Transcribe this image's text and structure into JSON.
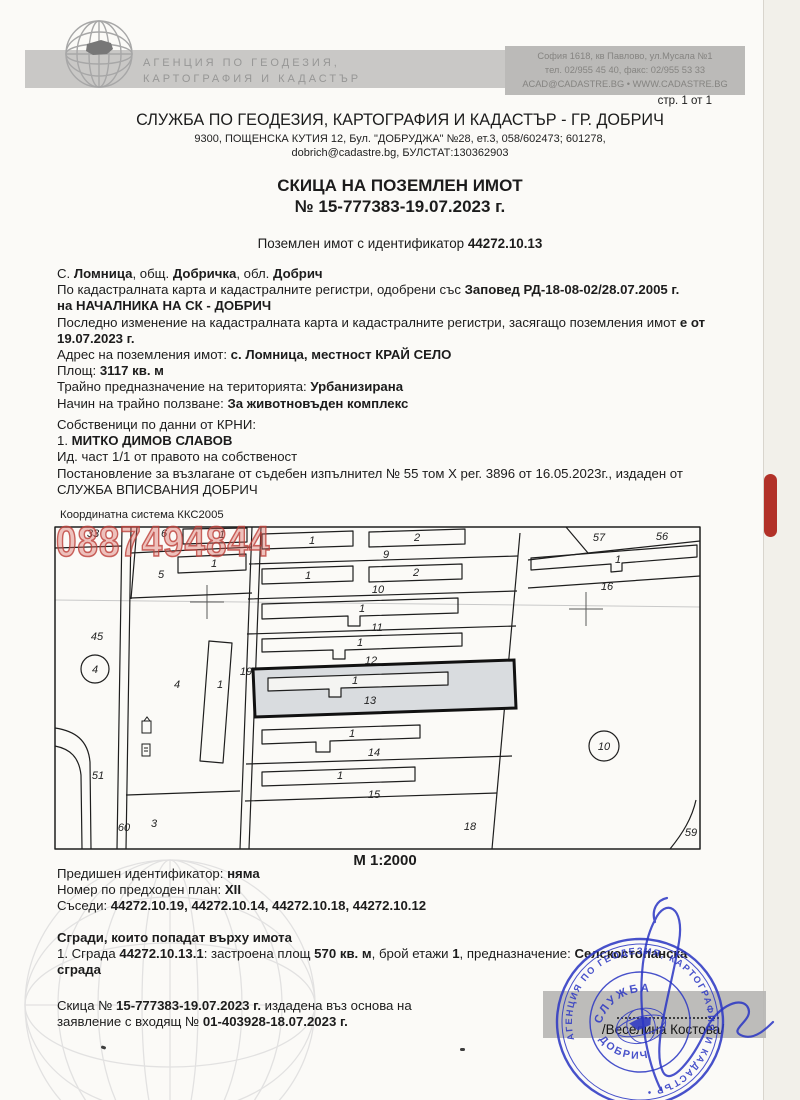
{
  "colors": {
    "accent_red": "#b23128",
    "stamp_blue": "#2f3ac4",
    "watermark_red": "#c0453f",
    "highlight_gray": "#d9dcdf"
  },
  "header": {
    "agency_line1": "АГЕНЦИЯ ПО ГЕОДЕЗИЯ,",
    "agency_line2": "КАРТОГРАФИЯ И КАДАСТЪР",
    "contact_line1": "София 1618, кв Павлово, ул.Мусала №1",
    "contact_line2": "тел. 02/955 45 40, факс: 02/955 53 33",
    "contact_line3": "ACAD@CADASTRE.BG • WWW.CADASTRE.BG",
    "page_num": "стр. 1 от 1",
    "office_title": "СЛУЖБА ПО ГЕОДЕЗИЯ, КАРТОГРАФИЯ И КАДАСТЪР - ГР. ДОБРИЧ",
    "office_addr1": "9300, ПОЩЕНСКА КУТИЯ 12, Бул. \"ДОБРУДЖА\" №28, ет.3, 058/602473; 601278,",
    "office_addr2": "dobrich@cadastre.bg, БУЛСТАТ:130362903"
  },
  "title": {
    "line1": "СКИЦА НА ПОЗЕМЛЕН ИМОТ",
    "line2": "№ 15-777383-19.07.2023 г."
  },
  "subtitle": [
    [
      "Поземлен имот с  идентификатор ",
      0
    ],
    [
      "44272.10.13",
      1
    ]
  ],
  "body": {
    "lines": [
      [
        [
          "С. ",
          0
        ],
        [
          "Ломница",
          1
        ],
        [
          ", общ. ",
          0
        ],
        [
          "Добричка",
          1
        ],
        [
          ", обл. ",
          0
        ],
        [
          "Добрич",
          1
        ]
      ],
      [
        [
          "По кадастралната карта и кадастралните регистри, одобрени със ",
          0
        ],
        [
          "Заповед РД-18-08-02/28.07.2005 г.",
          1
        ]
      ],
      [
        [
          "на НАЧАЛНИКА НА СК - ДОБРИЧ",
          1
        ]
      ],
      [
        [
          "Последно изменение на кадастралната карта и кадастралните регистри, засягащо поземления имот ",
          0
        ],
        [
          "е от",
          1
        ]
      ],
      [
        [
          "19.07.2023 г.",
          1
        ]
      ],
      [
        [
          "Адрес на поземления имот: ",
          0
        ],
        [
          "с. Ломница, местност КРАЙ СЕЛО",
          1
        ]
      ],
      [
        [
          "Площ: ",
          0
        ],
        [
          "3117 кв. м",
          1
        ]
      ],
      [
        [
          "Трайно предназначение на територията: ",
          0
        ],
        [
          "Урбанизирана",
          1
        ]
      ],
      [
        [
          "Начин на трайно ползване: ",
          0
        ],
        [
          "За животновъден комплекс",
          1
        ]
      ]
    ]
  },
  "owners": {
    "lines": [
      [
        [
          "Собственици по данни от КРНИ:",
          0
        ]
      ],
      [
        [
          "1. ",
          0
        ],
        [
          "МИТКО ДИМОВ СЛАВОВ",
          1
        ]
      ],
      [
        [
          "Ид. част 1/1 от правото на собственост",
          0
        ]
      ],
      [
        [
          "Постановление за възлагане от съдебен изпълнител № 55 том X рег. 3896 от 16.05.2023г., издаден от",
          0
        ]
      ],
      [
        [
          "СЛУЖБА ВПИСВАНИЯ ДОБРИЧ",
          0
        ]
      ]
    ]
  },
  "map": {
    "coord_system": "Координатна система ККС2005",
    "scale": "М 1:2000",
    "watermark": "0887494844",
    "highlighted_parcel": "13",
    "labels": [
      {
        "x": 93,
        "y": 537,
        "t": "33"
      },
      {
        "x": 164,
        "y": 537,
        "t": "6"
      },
      {
        "x": 222,
        "y": 538,
        "t": "1"
      },
      {
        "x": 161,
        "y": 578,
        "t": "5"
      },
      {
        "x": 214,
        "y": 567,
        "t": "1"
      },
      {
        "x": 97,
        "y": 640,
        "t": "45"
      },
      {
        "x": 177,
        "y": 688,
        "t": "4"
      },
      {
        "x": 220,
        "y": 688,
        "t": "1"
      },
      {
        "x": 246,
        "y": 675,
        "t": "19"
      },
      {
        "x": 98,
        "y": 779,
        "t": "51"
      },
      {
        "x": 124,
        "y": 831,
        "t": "60"
      },
      {
        "x": 154,
        "y": 827,
        "t": "3"
      },
      {
        "x": 312,
        "y": 544,
        "t": "1"
      },
      {
        "x": 417,
        "y": 541,
        "t": "2"
      },
      {
        "x": 386,
        "y": 558,
        "t": "9"
      },
      {
        "x": 308,
        "y": 579,
        "t": "1"
      },
      {
        "x": 416,
        "y": 576,
        "t": "2"
      },
      {
        "x": 378,
        "y": 593,
        "t": "10"
      },
      {
        "x": 362,
        "y": 612,
        "t": "1"
      },
      {
        "x": 377,
        "y": 631,
        "t": "11"
      },
      {
        "x": 360,
        "y": 646,
        "t": "1"
      },
      {
        "x": 371,
        "y": 664,
        "t": "12"
      },
      {
        "x": 355,
        "y": 684,
        "t": "1"
      },
      {
        "x": 370,
        "y": 704,
        "t": "13"
      },
      {
        "x": 352,
        "y": 737,
        "t": "1"
      },
      {
        "x": 374,
        "y": 756,
        "t": "14"
      },
      {
        "x": 340,
        "y": 779,
        "t": "1"
      },
      {
        "x": 374,
        "y": 798,
        "t": "15"
      },
      {
        "x": 470,
        "y": 830,
        "t": "18"
      },
      {
        "x": 599,
        "y": 541,
        "t": "57"
      },
      {
        "x": 662,
        "y": 540,
        "t": "56"
      },
      {
        "x": 618,
        "y": 563,
        "t": "1"
      },
      {
        "x": 607,
        "y": 590,
        "t": "16"
      },
      {
        "x": 691,
        "y": 836,
        "t": "59"
      }
    ],
    "circles": [
      {
        "x": 95,
        "y": 669,
        "r": 14,
        "t": "4"
      },
      {
        "x": 604,
        "y": 746,
        "r": 15,
        "t": "10"
      }
    ]
  },
  "footer": {
    "lines": [
      [
        [
          "Предишен идентификатор: ",
          0
        ],
        [
          "няма",
          1
        ]
      ],
      [
        [
          "Номер по предходен план: ",
          0
        ],
        [
          "XII",
          1
        ]
      ],
      [
        [
          "Съседи: ",
          0
        ],
        [
          "44272.10.19, 44272.10.14, 44272.10.18, 44272.10.12",
          1
        ]
      ]
    ],
    "buildings": [
      [
        [
          "Сгради, които попадат върху имота",
          1
        ]
      ],
      [
        [
          "1. Сграда ",
          0
        ],
        [
          "44272.10.13.1",
          1
        ],
        [
          ": застроена площ ",
          0
        ],
        [
          "570 кв. м",
          1
        ],
        [
          ", брой етажи ",
          0
        ],
        [
          "1",
          1
        ],
        [
          ", предназначение: ",
          0
        ],
        [
          "Селскостопанска",
          1
        ]
      ],
      [
        [
          "сграда",
          1
        ]
      ]
    ],
    "issue": [
      [
        [
          "Скица № ",
          0
        ],
        [
          "15-777383-19.07.2023 г.",
          1
        ],
        [
          " издадена въз основа на",
          0
        ]
      ],
      [
        [
          "заявление с входящ № ",
          0
        ],
        [
          "01-403928-18.07.2023 г.",
          1
        ]
      ]
    ]
  },
  "stamp": {
    "ring_text": "АГЕНЦИЯ ПО ГЕОДЕЗИЯ, КАРТОГРАФИЯ И КАДАСТЪР •",
    "inner_top": "СЛУЖБА",
    "inner_bottom": "ДОБРИЧ"
  },
  "signature_name": "/Веселина Костова/"
}
